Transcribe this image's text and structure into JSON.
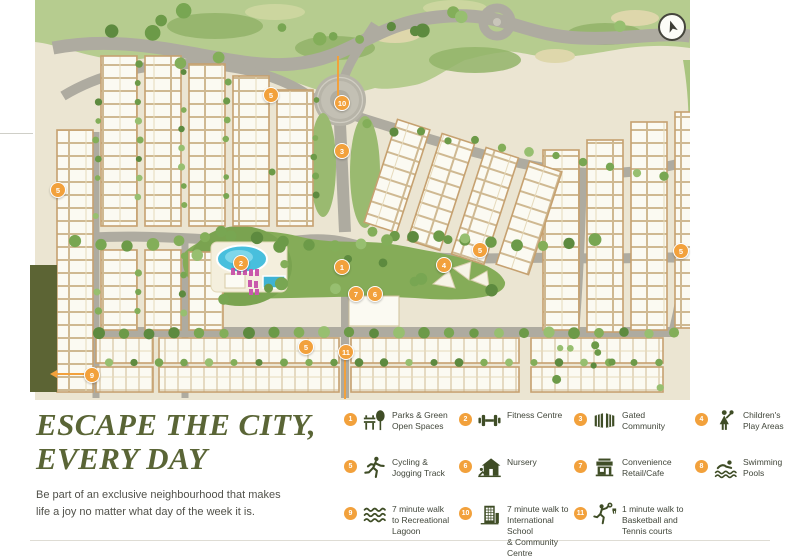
{
  "title": {
    "line1": "ESCAPE THE CITY,",
    "line2": "EVERY DAY"
  },
  "subtitle": "Be part of an exclusive neighbourhood that makes\nlife a joy no matter what day of the week it is.",
  "colors": {
    "accent_orange": "#F2A13C",
    "title_green": "#5A6536",
    "icon_olive": "#3F4D26",
    "map_cream": "#EBE5D2",
    "lagoon_blue": "#48BFDD",
    "olive_block": "#5C6434"
  },
  "legend": {
    "items": [
      {
        "num": "1",
        "icon": "park-bench-tree",
        "label": "Parks & Green\nOpen Spaces"
      },
      {
        "num": "2",
        "icon": "dumbbell",
        "label": "Fitness Centre"
      },
      {
        "num": "3",
        "icon": "gate",
        "label": "Gated\nCommunity"
      },
      {
        "num": "4",
        "icon": "child-balloon",
        "label": "Children's\nPlay Areas"
      },
      {
        "num": "5",
        "icon": "runner",
        "label": "Cycling &\nJogging Track"
      },
      {
        "num": "6",
        "icon": "nursery-house",
        "label": "Nursery"
      },
      {
        "num": "7",
        "icon": "shop",
        "label": "Convenience\nRetail/Cafe"
      },
      {
        "num": "8",
        "icon": "swimmer",
        "label": "Swimming\nPools"
      },
      {
        "num": "9",
        "icon": "waves",
        "label": "7 minute walk\nto Recreational\nLagoon"
      },
      {
        "num": "10",
        "icon": "school-building",
        "label": "7 minute walk to\nInternational School\n& Community Centre"
      },
      {
        "num": "11",
        "icon": "basketball-player",
        "label": "1 minute walk to\nBasketball and\nTennis courts"
      }
    ]
  },
  "map": {
    "compass": "north-arrow",
    "markers": [
      {
        "num": "5",
        "x": 57,
        "y": 189
      },
      {
        "num": "5",
        "x": 270,
        "y": 94
      },
      {
        "num": "10",
        "x": 341,
        "y": 102
      },
      {
        "num": "3",
        "x": 341,
        "y": 150
      },
      {
        "num": "2",
        "x": 240,
        "y": 262
      },
      {
        "num": "1",
        "x": 341,
        "y": 266
      },
      {
        "num": "7",
        "x": 355,
        "y": 293
      },
      {
        "num": "6",
        "x": 374,
        "y": 293
      },
      {
        "num": "4",
        "x": 443,
        "y": 264
      },
      {
        "num": "5",
        "x": 479,
        "y": 249
      },
      {
        "num": "5",
        "x": 305,
        "y": 346
      },
      {
        "num": "11",
        "x": 345,
        "y": 351
      },
      {
        "num": "9",
        "x": 91,
        "y": 374
      },
      {
        "num": "5",
        "x": 680,
        "y": 250
      }
    ]
  }
}
